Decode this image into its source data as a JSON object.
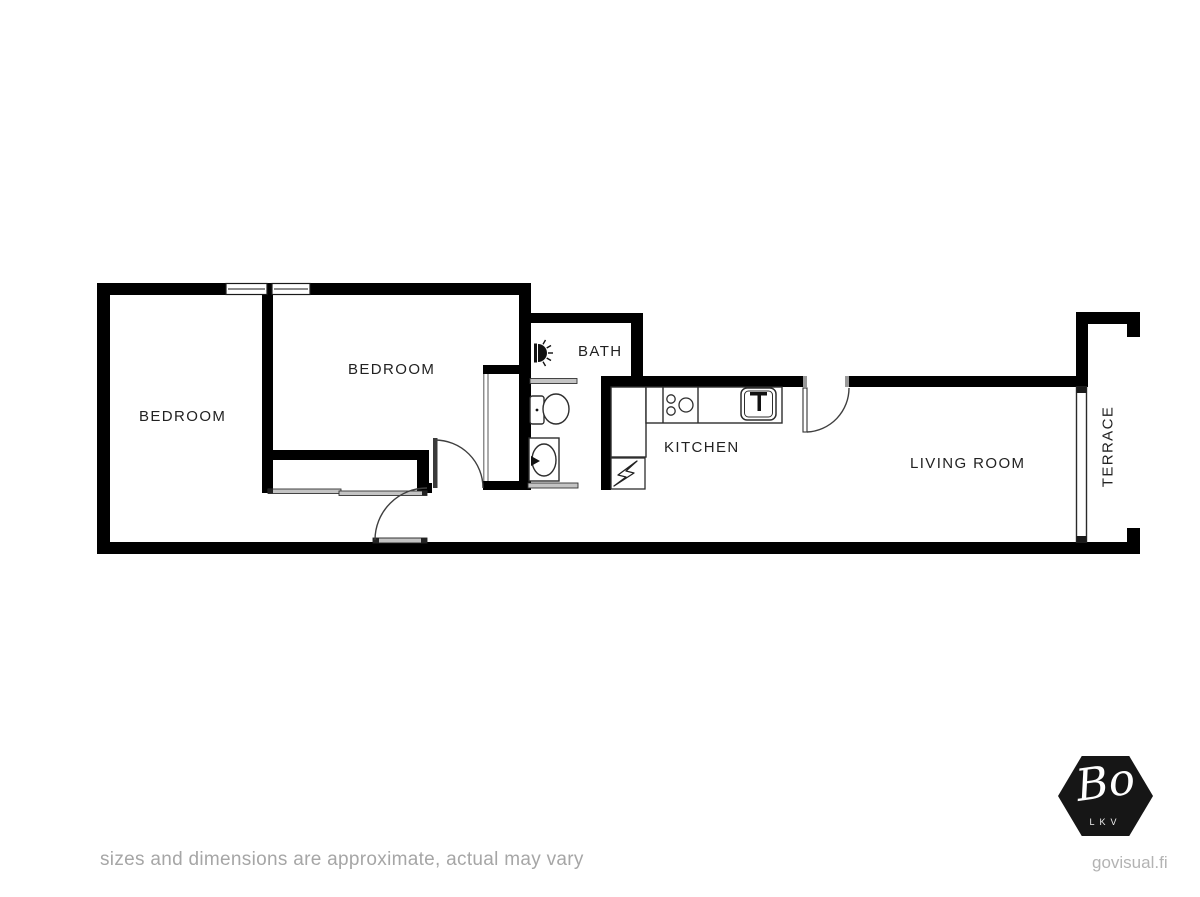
{
  "labels": {
    "bedroom1": "BEDROOM",
    "bedroom2": "BEDROOM",
    "bath": "BATH",
    "kitchen": "KITCHEN",
    "living_room": "LIVING ROOM",
    "terrace": "TERRACE"
  },
  "footer": {
    "disclaimer": "sizes and dimensions are approximate, actual may vary"
  },
  "branding": {
    "logo_text": "Bo",
    "logo_subtext": "LKV",
    "website": "govisual.fi",
    "logo_bg": "#161616"
  },
  "icons": {
    "shower_icon": "half-dome-with-rays",
    "toilet_icon": "tank-and-oval-bowl",
    "bath_sink_icon": "oval-basin-with-tap",
    "stove_icon": "three-burner-circles",
    "kitchen_sink_icon": "rounded-square-basin-with-faucet",
    "electrical_panel_icon": "lightning-bolt"
  },
  "colors": {
    "wall": "#000000",
    "fixture_line": "#2e2e2e",
    "door_line": "#3f3f3f",
    "slider_fill": "#c4c4c4",
    "label_text": "#222222",
    "muted_text": "#a6a6a6"
  }
}
